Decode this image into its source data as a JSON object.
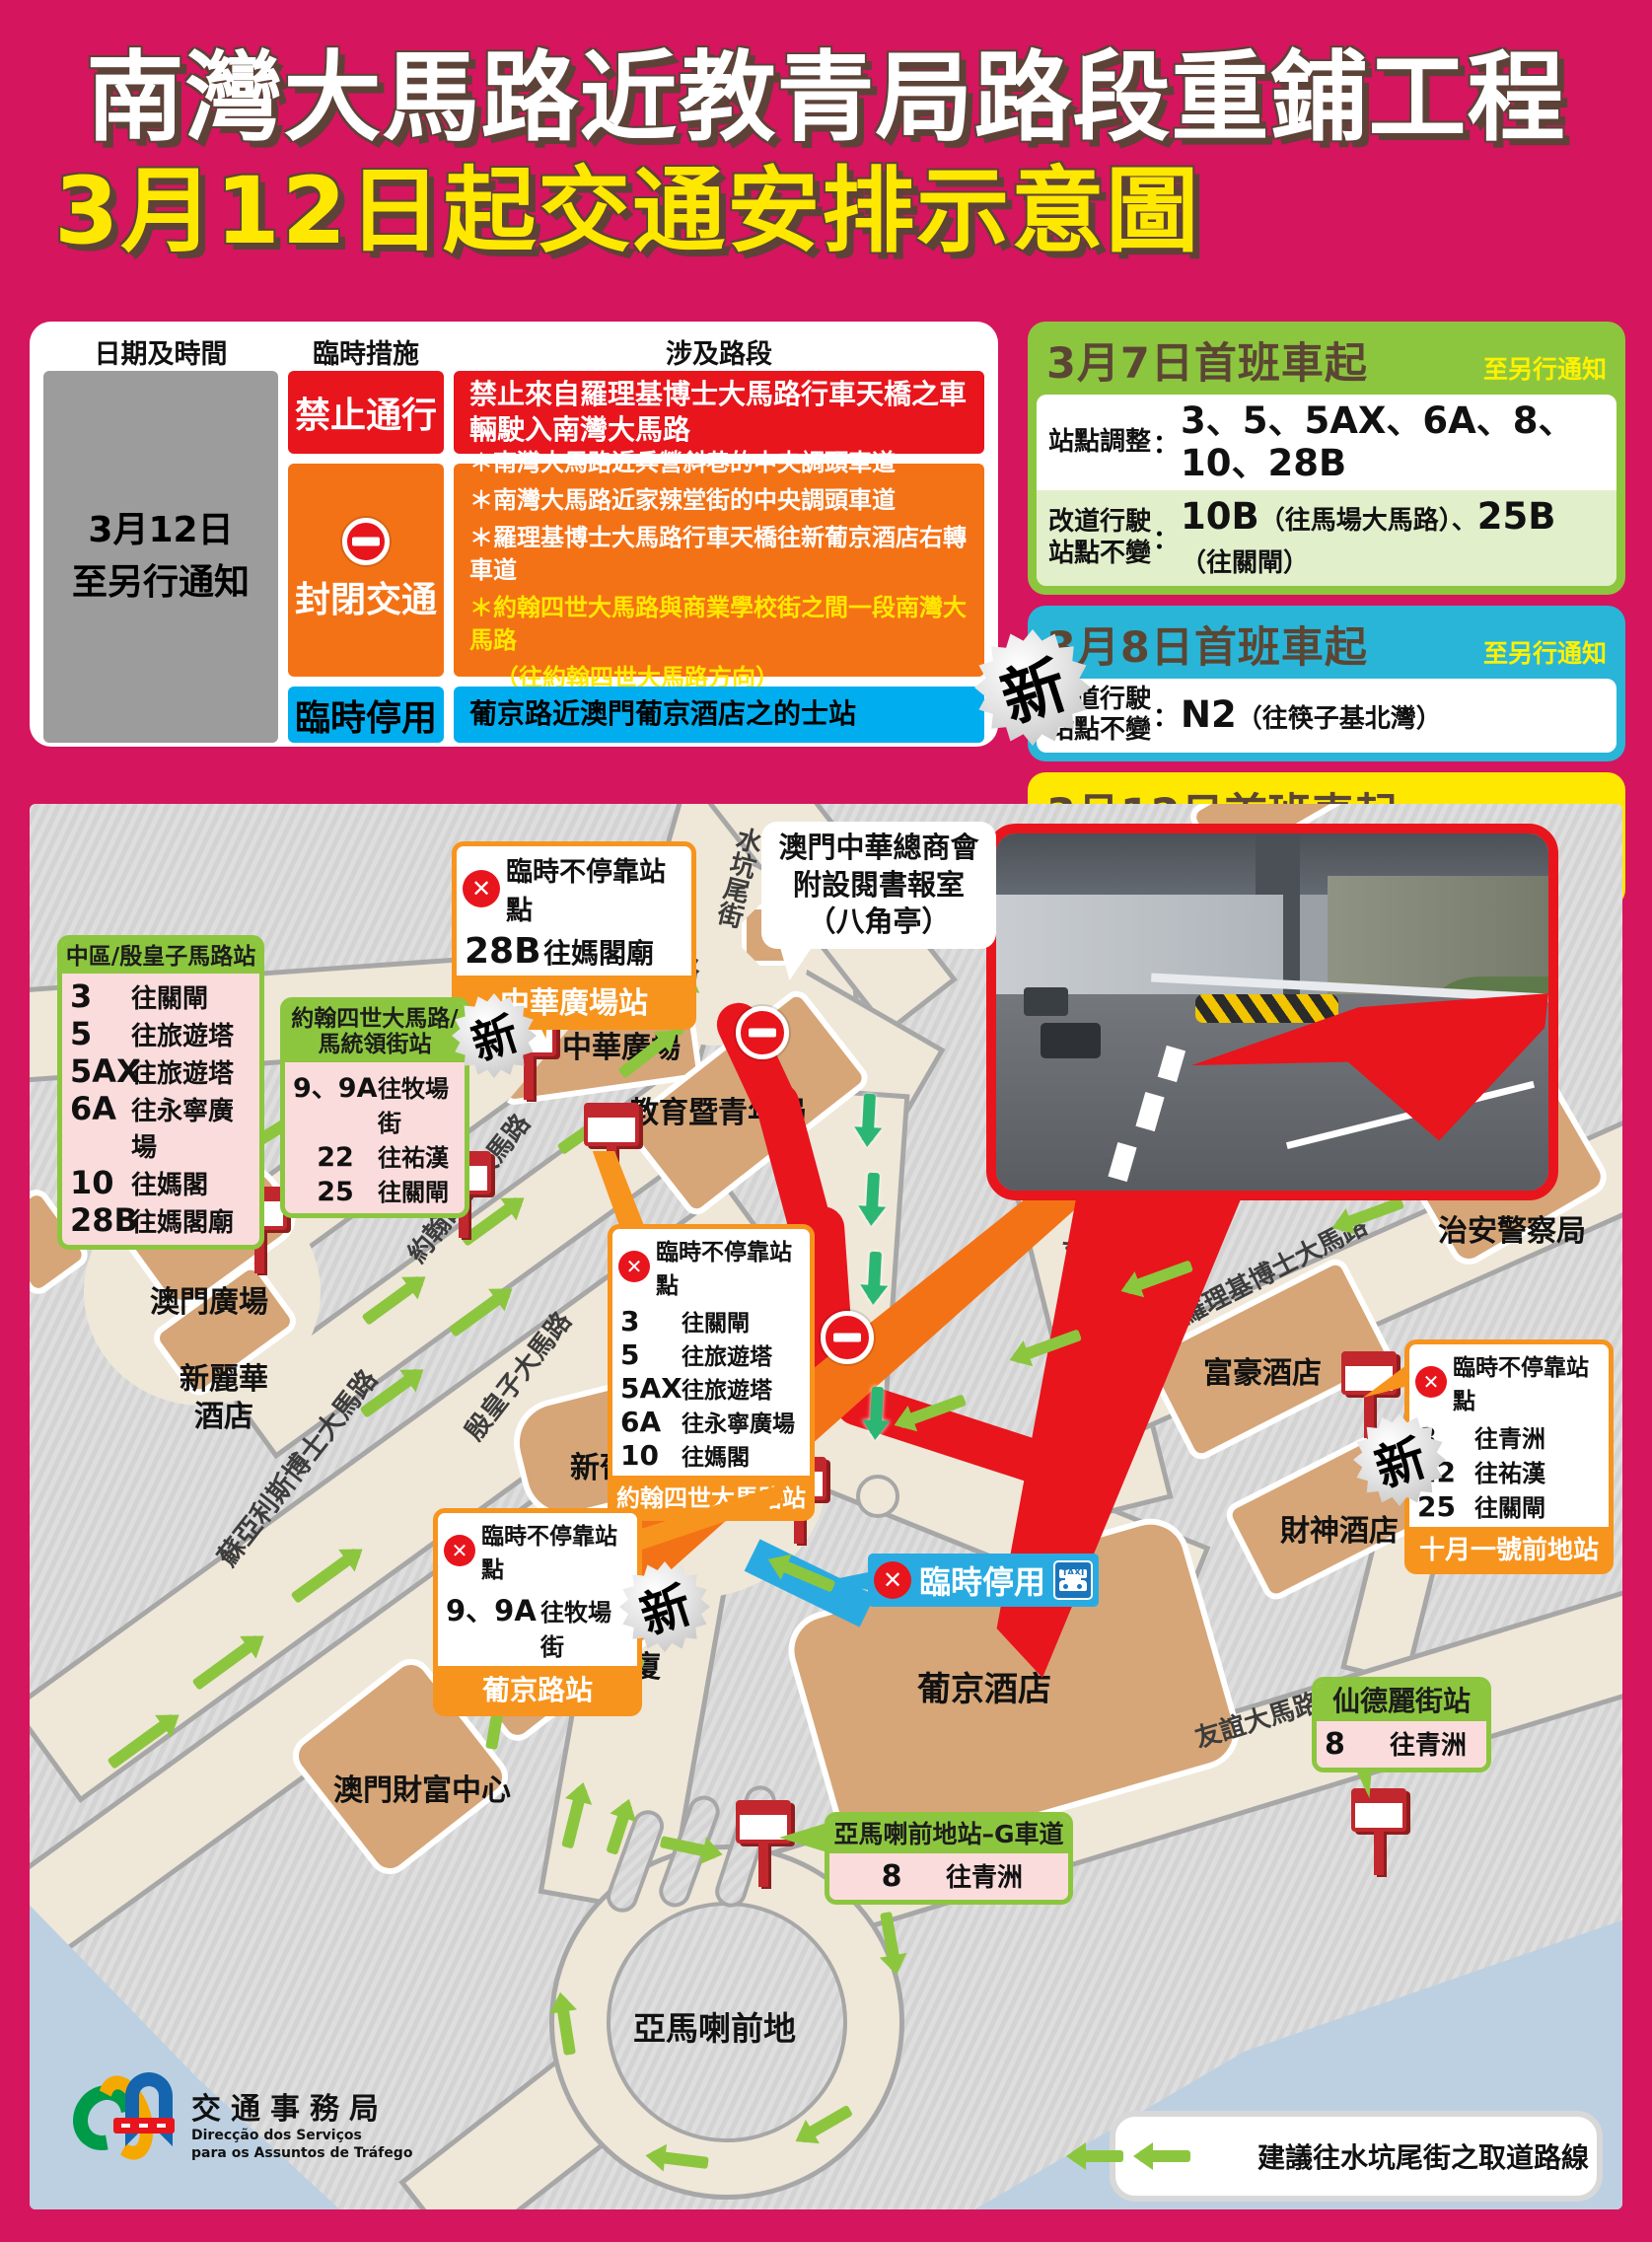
{
  "title": {
    "line1": "南灣大馬路近教青局路段重鋪工程",
    "line2": "3月12日起交通安排示意圖"
  },
  "punct": {
    "colon": "：",
    "sep": "、",
    "star": "＊"
  },
  "new_badge": "新",
  "table": {
    "col_headers": [
      "日期及時間",
      "臨時措施",
      "涉及路段"
    ],
    "date_line1": "3月12日",
    "date_line2": "至另行通知",
    "rows": {
      "ban": {
        "measure": "禁止通行",
        "detail": "禁止來自羅理基博士大馬路行車天橋之車輛駛入南灣大馬路"
      },
      "close": {
        "measure": "封閉交通",
        "bullet1": "＊南灣大馬路近兵營斜巷的中央調頭車道",
        "bullet2": "＊南灣大馬路近家辣堂街的中央調頭車道",
        "bullet3": "＊羅理基博士大馬路行車天橋往新葡京酒店右轉車道",
        "bullet4": "＊約翰四世大馬路與商業學校街之間一段南灣大馬路",
        "bullet4b": "（往約翰四世大馬路方向）"
      },
      "suspend": {
        "measure": "臨時停用",
        "detail": "葡京路近澳門葡京酒店之的士站"
      }
    }
  },
  "notices": [
    {
      "date": "3月7日首班車起",
      "until": "至另行通知",
      "row1_label": "站點調整",
      "row1_value": "3、5、5AX、6A、8、10、28B",
      "row2_label1": "改道行駛",
      "row2_label2": "站點不變",
      "row2_no1": "10B",
      "row2_dest1": "（往馬場大馬路）",
      "row2_no2": "25B",
      "row2_dest2": "（往關閘）"
    },
    {
      "date": "3月8日首班車起",
      "until": "至另行通知",
      "row_label1": "改道行駛",
      "row_label2": "站點不變",
      "no": "N2",
      "dest": "（往筷子基北灣）"
    },
    {
      "date": "3月12日首班車起",
      "until": "至另行通知",
      "row_label": "站點調整",
      "row_value": "9、9A、22、25"
    }
  ],
  "map": {
    "buildings": {
      "chong_wa": "中華廣場",
      "dsej": "教育暨青年局",
      "macau_square": "澳門廣場",
      "sintra1": "新麗華",
      "sintra2": "酒店",
      "grand_lisboa": "新葡京酒店",
      "bank_of_china": "中國銀行大廈",
      "fortuna_center": "澳門財富中心",
      "lisboa": "葡京酒店",
      "regal": "富豪酒店",
      "caishen": "財神酒店",
      "police": "治安警察局",
      "rotunda": "亞馬喇前地"
    },
    "roads": {
      "nam_van": "南灣大馬路",
      "shui_hang_mei": "水坑尾街",
      "joao4": "約翰四世大馬路",
      "infante": "殷皇子大馬路",
      "soares": "蘇亞利斯博士大馬路",
      "cacilhas": "加思欄馬路",
      "rodrigues": "羅理基博士大馬路",
      "cantao": "廣州街",
      "amizade": "友誼大馬路"
    },
    "bubble": {
      "line1": "澳門中華總商會",
      "line2": "附設閱書報室",
      "line3": "（八角亭）"
    },
    "taxi": {
      "label": "臨時停用",
      "sign": "TAXI"
    },
    "legend": "建議往水坑尾街之取道路線",
    "callouts": {
      "chong_wa_stop": {
        "title": "臨時不停靠站點",
        "routes": [
          {
            "no": "28B",
            "dest": "往媽閣廟"
          }
        ],
        "station": "中華廣場站"
      },
      "central_district": {
        "station": "中區/殷皇子馬路站",
        "routes": [
          {
            "no": "3",
            "dest": "往關閘"
          },
          {
            "no": "5",
            "dest": "往旅遊塔"
          },
          {
            "no": "5AX",
            "dest": "往旅遊塔"
          },
          {
            "no": "6A",
            "dest": "往永寧廣場"
          },
          {
            "no": "10",
            "dest": "往媽閣"
          },
          {
            "no": "28B",
            "dest": "往媽閣廟"
          }
        ]
      },
      "joao4_station": {
        "station_line1": "約翰四世大馬路/",
        "station_line2": "馬統領街站",
        "routes": [
          {
            "no": "9、9A",
            "dest": "往牧場街"
          },
          {
            "no": "22",
            "dest": "往祐漢"
          },
          {
            "no": "25",
            "dest": "往關閘"
          }
        ]
      },
      "joao4_stop": {
        "title": "臨時不停靠站點",
        "routes": [
          {
            "no": "3",
            "dest": "往關閘"
          },
          {
            "no": "5",
            "dest": "往旅遊塔"
          },
          {
            "no": "5AX",
            "dest": "往旅遊塔"
          },
          {
            "no": "6A",
            "dest": "往永寧廣場"
          },
          {
            "no": "10",
            "dest": "往媽閣"
          }
        ],
        "station": "約翰四世大馬路站"
      },
      "lisboa_road_stop": {
        "title": "臨時不停靠站點",
        "routes": [
          {
            "no": "9、9A",
            "dest": "往牧場街"
          }
        ],
        "station": "葡京路站"
      },
      "october1_stop": {
        "title": "臨時不停靠站點",
        "routes": [
          {
            "no": "8",
            "dest": "往青洲"
          },
          {
            "no": "22",
            "dest": "往祐漢"
          },
          {
            "no": "25",
            "dest": "往關閘"
          }
        ],
        "station": "十月一號前地站"
      },
      "sidonio": {
        "station": "仙德麗街站",
        "routes": [
          {
            "no": "8",
            "dest": "往青洲"
          }
        ]
      },
      "amaral_g": {
        "station": "亞馬喇前地站–G車道",
        "routes": [
          {
            "no": "8",
            "dest": "往青洲"
          }
        ]
      }
    }
  },
  "logo": {
    "zh": "交通事務局",
    "pt1": "Direcção dos Serviços",
    "pt2": "para os Assuntos de Tráfego"
  },
  "colors": {
    "page_bg": "#D5155E",
    "red": "#E8151C",
    "orange": "#F47216",
    "cyan": "#00AEEF",
    "green": "#8CC63F",
    "yellow": "#FFE800",
    "blue": "#29ABE2",
    "road": "#EFE7D8",
    "building": "#D6A678",
    "water": "#BCD0E2"
  }
}
